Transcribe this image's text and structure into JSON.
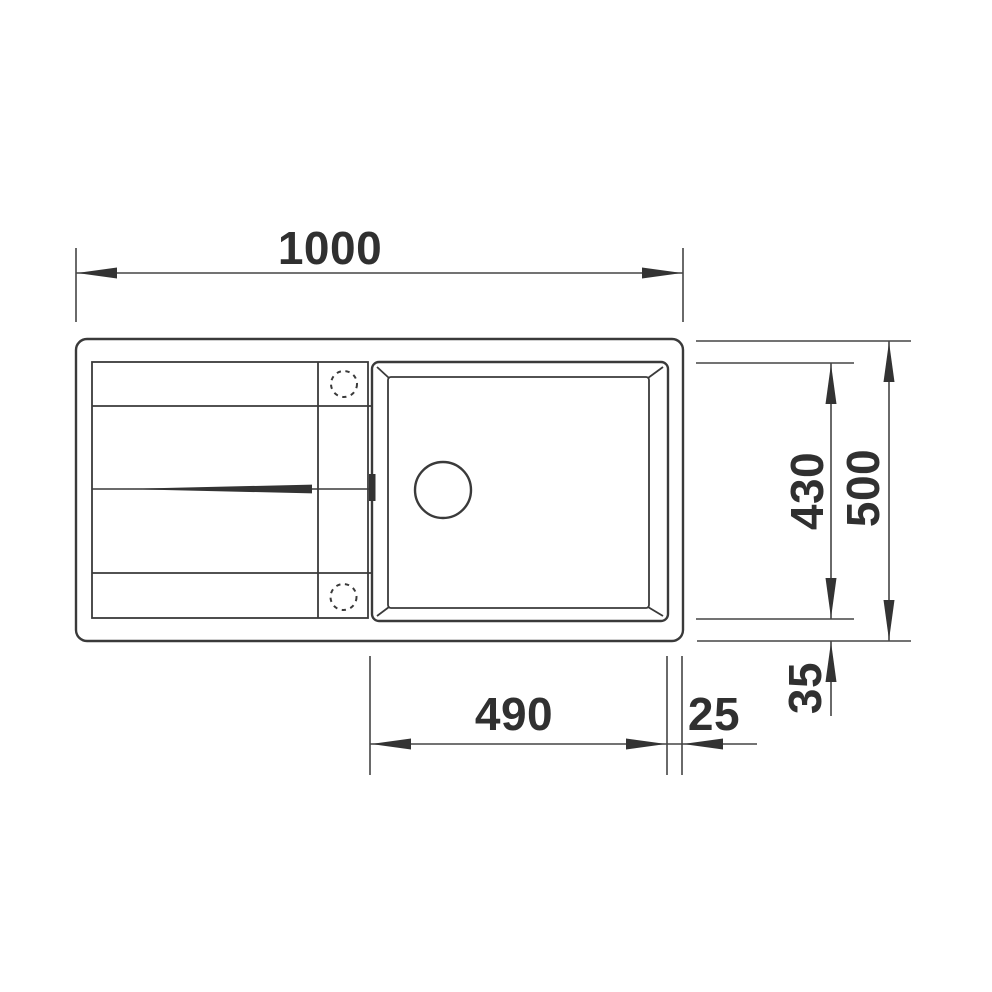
{
  "diagram": {
    "kind": "sink-top-view-technical-drawing",
    "colors": {
      "line": "#3a3a3a",
      "dimension_line": "#454545",
      "text": "#303030",
      "background": "#ffffff"
    },
    "dimensions": {
      "overall_width": "1000",
      "overall_depth": "500",
      "bowl_depth": "430",
      "bowl_width": "490",
      "right_rim_offset": "25",
      "bottom_rim_offset": "35"
    }
  }
}
